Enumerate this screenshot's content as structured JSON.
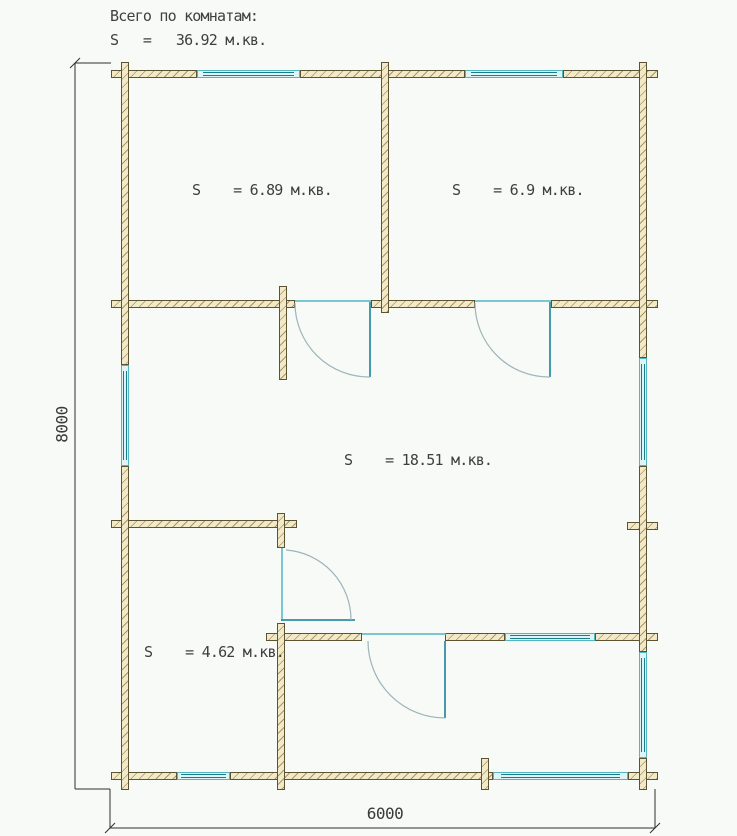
{
  "title": {
    "line1": "Всего по комнатам:",
    "line2": "S   =   36.92 м.кв."
  },
  "total_area_m2": "36.92",
  "rooms": [
    {
      "name": "top-left-room",
      "area_label": "S    = 6.89 м.кв.",
      "area_m2": "6.89"
    },
    {
      "name": "top-right-room",
      "area_label": "S    = 6.9 м.кв.",
      "area_m2": "6.9"
    },
    {
      "name": "central-room",
      "area_label": "S    = 18.51 м.кв.",
      "area_m2": "18.51"
    },
    {
      "name": "bottom-left-room",
      "area_label": "S    = 4.62 м.кв.",
      "area_m2": "4.62"
    }
  ],
  "dimensions": {
    "height": "8000",
    "width": "6000"
  },
  "colors": {
    "background": "#f8faf7",
    "wall_fill": "#f2e9c9",
    "wall_border": "#5c5430",
    "wall_hatch": "#806c34",
    "window_band": "#dff4f7",
    "window_frame": "#4fb6c2",
    "window_glass": "#1b7c8a",
    "door_leaf": "#2f8fa0",
    "door_arc": "#9db4b8",
    "dimension_line": "#2f2f2f",
    "text": "#3f3f3f"
  }
}
